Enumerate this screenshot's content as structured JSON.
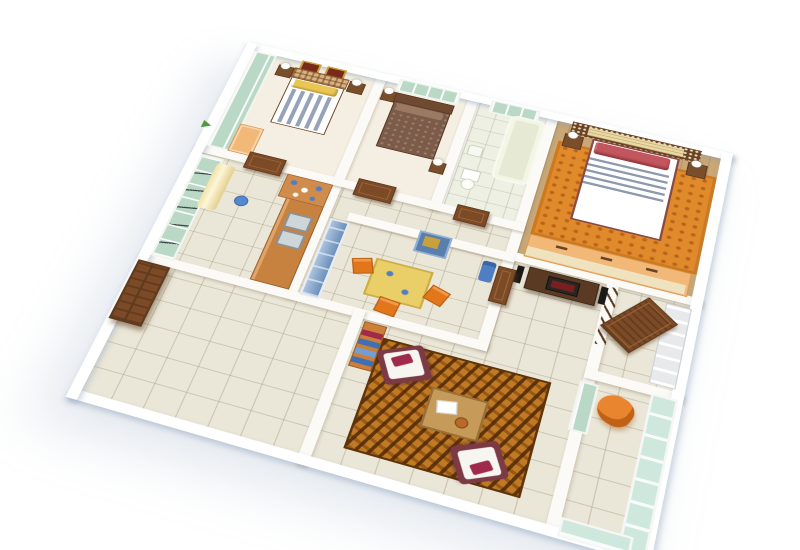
{
  "scene": {
    "description": "3D isometric cutaway rendering of an apartment floor plan on a white background",
    "rooms": [
      "bedroom-with-striped-bed",
      "bedroom-with-brown-bed",
      "bathroom",
      "master-bedroom",
      "corridor",
      "kitchen",
      "utility-glass-balcony",
      "dining-room",
      "foyer-entrance",
      "terrace",
      "living-room",
      "balcony"
    ],
    "objects": [
      "striped-bed",
      "yellow-pillows",
      "wall-pictures",
      "glass-wardrobe",
      "brown-bed",
      "bathtub",
      "toilet",
      "wash-basin",
      "master-bed",
      "lattice-headboard",
      "orange-rug",
      "nightstands",
      "table-lamps",
      "dresser-unit",
      "tv-console",
      "tv",
      "speakers",
      "kitchen-counter",
      "double-sink",
      "wall-shelf",
      "curtain",
      "dining-table",
      "dining-chairs",
      "water-cooler",
      "wall-art",
      "blue-wardrobe",
      "front-door-open",
      "interior-doors",
      "double-terrace-door",
      "woven-carpet",
      "armchairs",
      "coffee-table",
      "bookshelf",
      "balcony-glazing",
      "orange-lounge-chair",
      "plant"
    ]
  },
  "palette": {
    "bg": "#ffffff",
    "wall": "#fbfaf6",
    "tile": "#ebe7d8",
    "bedroomFloor": "#f4efe2",
    "bathFloor": "#eef0e4",
    "wood": "#c9a776",
    "glassGreen": "#b9d8c6",
    "glassBlue": "#7fa3cd",
    "glassTeal": "#cfe8de",
    "doorBrown": "#7c4a26",
    "doorPanel": "#9a6636",
    "doorDark": "#5f3b1e",
    "counter": "#c8823f",
    "shelf": "#cf8c4c",
    "curtain": "#f0e2a8",
    "tableYellow": "#eace68",
    "chairOrange": "#e2761b",
    "carpetBase": "#c07a24",
    "carpetDark": "#5f3408",
    "rugOrange": "#e08a2c",
    "rugDot": "#96460a",
    "stripeBlue": "#96a2b8",
    "pillowYellow": "#e9c654",
    "bedBrown": "#7d5b49",
    "pillowRed": "#c2565e",
    "duvetStripe": "#8d99ad",
    "headboardCream": "#ead9a8",
    "lattice": "#6a4226",
    "sofaMaroon": "#7c3a44",
    "cushionWhite": "#f7f5f0",
    "pillowCrimson": "#a02a4a",
    "coffee": "#c69a58",
    "bookshelf": "#cd7f3a",
    "books": "#3f6fb5",
    "cooler": "#4f7fc2",
    "tvDark": "#2a2622",
    "screen": "#7a1f1f",
    "lounge": "#e8852e",
    "gold": "#c9a13b",
    "pictureRed": "#7a2a1a",
    "pictureBlue": "#5a7fae",
    "tub": "#f6f8ea",
    "steel": "#cfd6da",
    "lamp": "#ffffff",
    "nightstand": "#7a4e2a",
    "peach": "#f2b878",
    "creamPanel": "#efe3bf",
    "plantGreen": "#4a9a3a"
  }
}
